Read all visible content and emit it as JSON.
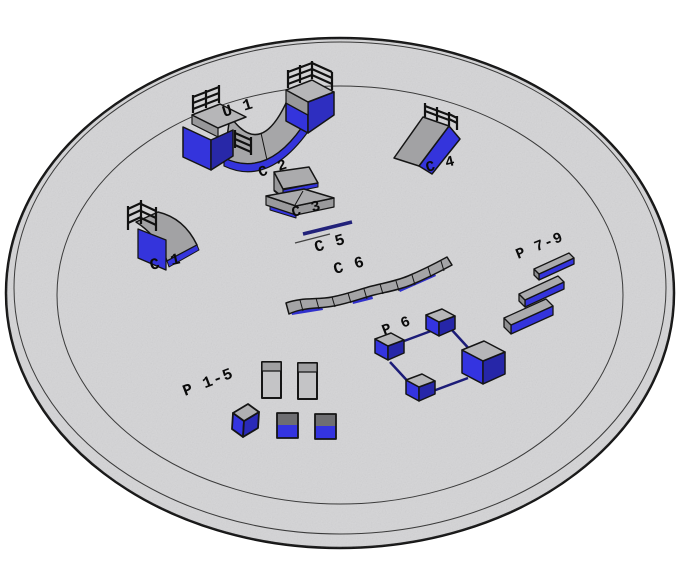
{
  "scene": {
    "description": "3D perspective render of a circular skatepark slab with labeled ramps and obstacles",
    "platform": {
      "shape": "circular slab",
      "fill": "#d4d4d6",
      "outline": "#151515",
      "ring_count": 3
    },
    "colors": {
      "surface_gray": "#a4a4a6",
      "deck_gray": "#b6b6b8",
      "pillar_gray": "#c4c4c6",
      "pillar_band_gray": "#a0a0a2",
      "dark_band_gray": "#6e6e72",
      "accent_blue": "#3434dc",
      "accent_blue_dark": "#2828a8",
      "rail_navy": "#1c1c78",
      "outline_black": "#151515",
      "label_black": "#0b0b0b"
    },
    "objects": [
      {
        "id": "u1",
        "label": "U 1",
        "kind": "mini-halfpipe"
      },
      {
        "id": "c1",
        "label": "C 1",
        "kind": "quarter-pipe"
      },
      {
        "id": "c2",
        "label": "C 2",
        "kind": "platform-box"
      },
      {
        "id": "c3",
        "label": "C 3",
        "kind": "platform-box"
      },
      {
        "id": "c4",
        "label": "C 4",
        "kind": "bank-ramp-with-rail"
      },
      {
        "id": "c5",
        "label": "C 5",
        "kind": "flat-rail"
      },
      {
        "id": "c6",
        "label": "C 6",
        "kind": "wave-ledge"
      },
      {
        "id": "p6",
        "label": "P 6",
        "kind": "box-and-rail-course"
      },
      {
        "id": "p15",
        "label": "P 1-5",
        "kind": "block-set"
      },
      {
        "id": "p79",
        "label": "P 7-9",
        "kind": "ledge-set"
      }
    ]
  }
}
